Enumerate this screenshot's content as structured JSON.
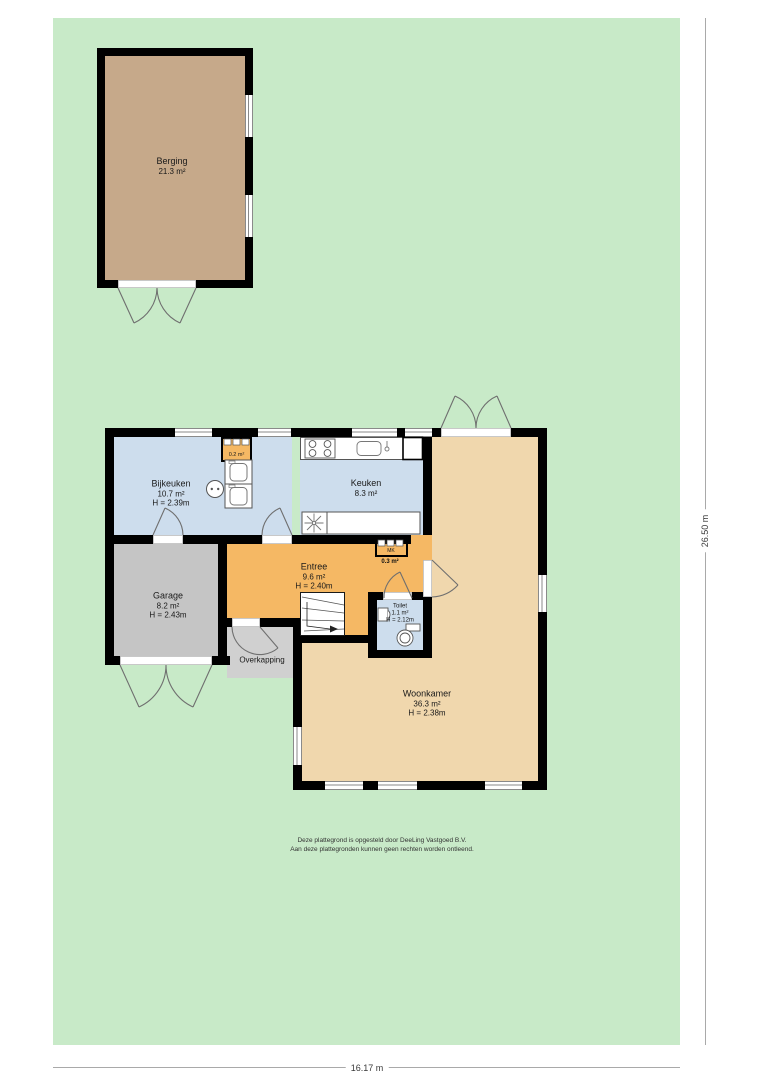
{
  "rooms": {
    "berging": {
      "name": "Berging",
      "area": "21.3 m²"
    },
    "bijkeuken": {
      "name": "Bijkeuken",
      "area": "10.7 m²",
      "height": "H = 2.39m"
    },
    "keuken": {
      "name": "Keuken",
      "area": "8.3 m²"
    },
    "garage": {
      "name": "Garage",
      "area": "8.2 m²",
      "height": "H = 2.43m"
    },
    "entree": {
      "name": "Entree",
      "area": "9.6 m²",
      "height": "H = 2.40m"
    },
    "toilet": {
      "name": "Toilet",
      "area": "1.1 m²",
      "height": "H = 2.12m"
    },
    "woonkamer": {
      "name": "Woonkamer",
      "area": "36.3 m²",
      "height": "H = 2.38m"
    },
    "overkapping": {
      "name": "Overkapping"
    },
    "kast": {
      "area": "0.2 m²"
    },
    "meterkast": {
      "label": "MK",
      "area": "0.3 m²"
    }
  },
  "dimensions": {
    "width": "16.17 m",
    "height": "26.50 m"
  },
  "disclaimer": {
    "line1": "Deze plattegrond is opgesteld door DeeLing Vastgoed B.V.",
    "line2": "Aan deze plattegronden kunnen geen rechten worden ontleend."
  },
  "colors": {
    "garden": "#c8eac8",
    "berging_floor": "#c6a98a",
    "wet_room_floor": "#cddded",
    "entree_floor": "#f5b864",
    "living_floor": "#f0d7ad",
    "garage_floor": "#c5c5c5",
    "overkapping_floor": "#d0d0d0",
    "wall": "#000000"
  }
}
